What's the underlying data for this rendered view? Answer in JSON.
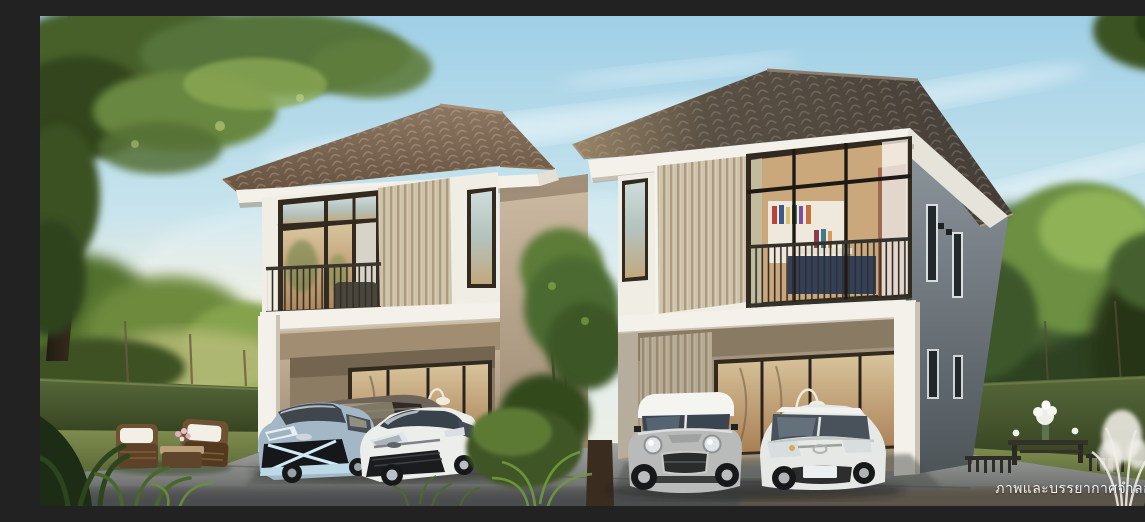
{
  "scene": {
    "kind": "3d-architectural-rendering",
    "subject": "Two modern two-storey detached houses with carports, parked cars and a landscaped tropical garden under a clear morning sky",
    "watermark": {
      "text": "ภาพและบรรยากาศจำลอง"
    }
  },
  "colors": {
    "sky-top": "#9fcfe6",
    "sky-mid": "#cfe7ee",
    "sky-horizon": "#f1efdf",
    "sun-glow": "#f7ecd2",
    "roof-left": "#7e6751",
    "roof-right": "#4b433a",
    "fascia-white": "#f3f1ea",
    "wall-cream": "#f0ede4",
    "wall-tan": "#b7a48c",
    "wall-gray": "#7e878d",
    "slat-cream": "#ded2ba",
    "frame-dark": "#32291f",
    "railing-dark": "#3a362e",
    "glass-warm": "#c3a274",
    "glass-cool": "#c2d2d4",
    "hedge-green": "#46552c",
    "tree-green": "#5f7b3a",
    "grass-green": "#6e7d45",
    "driveway-gray": "#959794",
    "driveway-dark": "#4b4e4f",
    "car-yaris-blue": "#a3b7c6",
    "car-mpv-gray": "#6f6459",
    "car-white": "#eaece9",
    "car-mini-silver": "#b8bbba",
    "wicker-brown": "#6f5232",
    "cushion-white": "#f2f0e6",
    "watermark-white": "#ffffff"
  },
  "objects": {
    "houses": [
      "left-two-storey-house",
      "right-two-storey-house"
    ],
    "cars": [
      "blue-gray-hatchback",
      "dark-gray-mpv",
      "white-sedan",
      "silver-mini-cooper",
      "white-hatchback"
    ],
    "garden": [
      "rattan-furniture-set",
      "coffee-table",
      "garden-bench",
      "flower-vase",
      "hedge-walls",
      "large-tree",
      "white-plume-plant"
    ]
  }
}
